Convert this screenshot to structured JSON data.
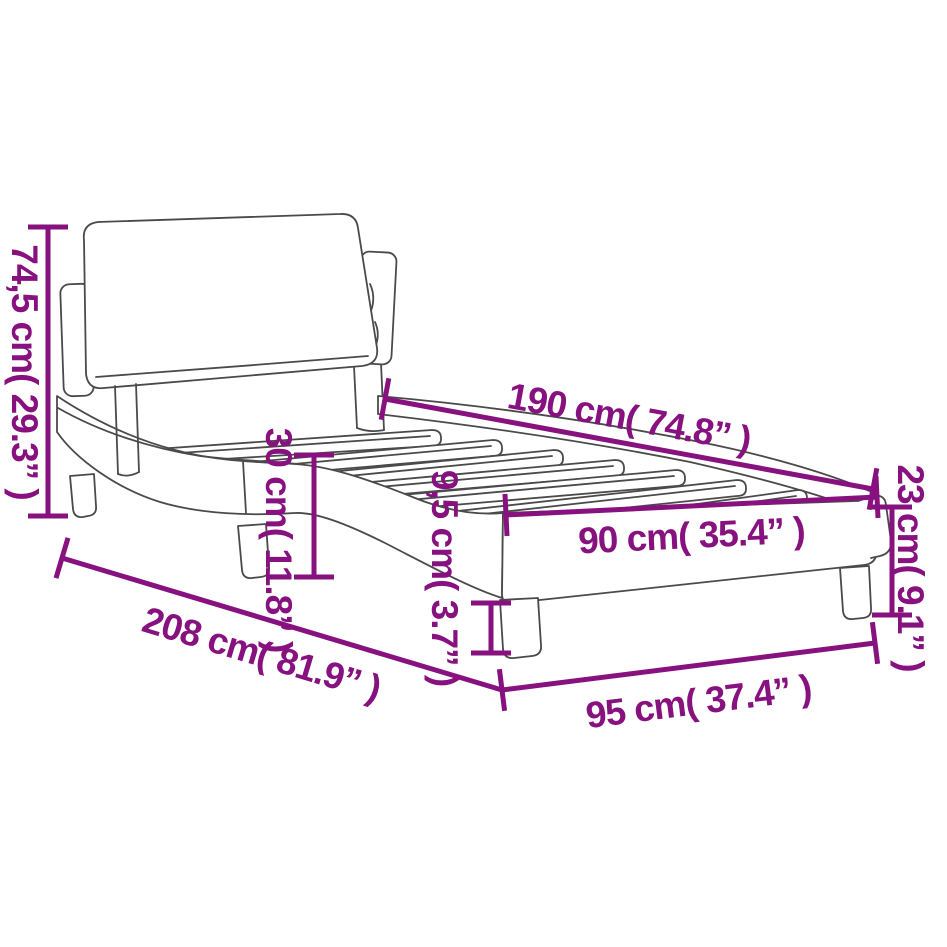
{
  "diagram": {
    "type": "product-dimension-diagram",
    "subject": "bed-frame-with-headboard",
    "background_color": "#ffffff",
    "outline_color": "#4a4a4a",
    "dimension_color": "#87117E",
    "dimensions": [
      {
        "id": "headboard-height",
        "label": "74,5 cm( 29.3” )",
        "cm": "74,5",
        "inch": "29.3",
        "orientation": "vertical-left"
      },
      {
        "id": "bed-length",
        "label": "190 cm( 74.8” )",
        "cm": "190",
        "inch": "74.8",
        "orientation": "diagonal-top"
      },
      {
        "id": "frame-height",
        "label": "30 cm( 11.8” )",
        "cm": "30",
        "inch": "11.8",
        "orientation": "vertical-middle"
      },
      {
        "id": "slat-height",
        "label": "9,5 cm( 3.7” )",
        "cm": "9,5",
        "inch": "3.7",
        "orientation": "vertical-middle"
      },
      {
        "id": "bed-width",
        "label": "90 cm( 35.4” )",
        "cm": "90",
        "inch": "35.4",
        "orientation": "horizontal-middle"
      },
      {
        "id": "foot-height",
        "label": "23 cm( 9.1” )",
        "cm": "23",
        "inch": "9.1",
        "orientation": "vertical-right"
      },
      {
        "id": "total-length",
        "label": "208 cm( 81.9” )",
        "cm": "208",
        "inch": "81.9",
        "orientation": "diagonal-bottom"
      },
      {
        "id": "total-width",
        "label": "95 cm( 37.4” )",
        "cm": "95",
        "inch": "37.4",
        "orientation": "horizontal-bottom"
      }
    ]
  }
}
